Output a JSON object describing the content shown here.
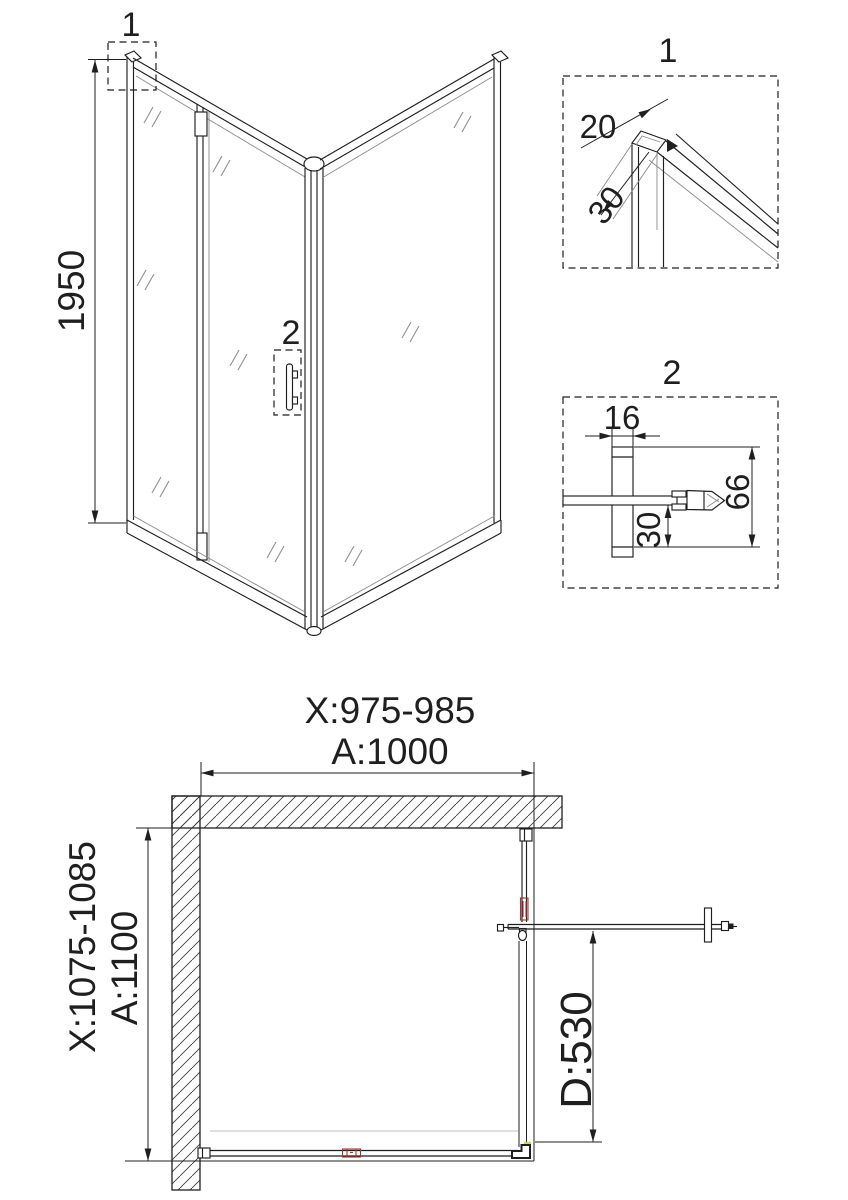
{
  "document": {
    "kind": "shower-enclosure-installation-drawing"
  },
  "view3d": {
    "dim_height": "1950",
    "callout_top": "1",
    "callout_handle": "2"
  },
  "detail1": {
    "title": "1",
    "dim_profile_width": "20",
    "dim_profile_depth": "30"
  },
  "detail2": {
    "title": "2",
    "dim_profile_width": "16",
    "dim_total_height": "66",
    "dim_offset": "30"
  },
  "plan": {
    "dim_adjust_width": "X:975-985",
    "dim_width": "A:1000",
    "dim_adjust_depth": "X:1075-1085",
    "dim_depth": "A:1100",
    "dim_door": "D:530"
  },
  "colors": {
    "line": "#1f1f1f",
    "accent_red": "#a43333",
    "accent_yellow": "#ddd04a",
    "background": "#ffffff"
  }
}
